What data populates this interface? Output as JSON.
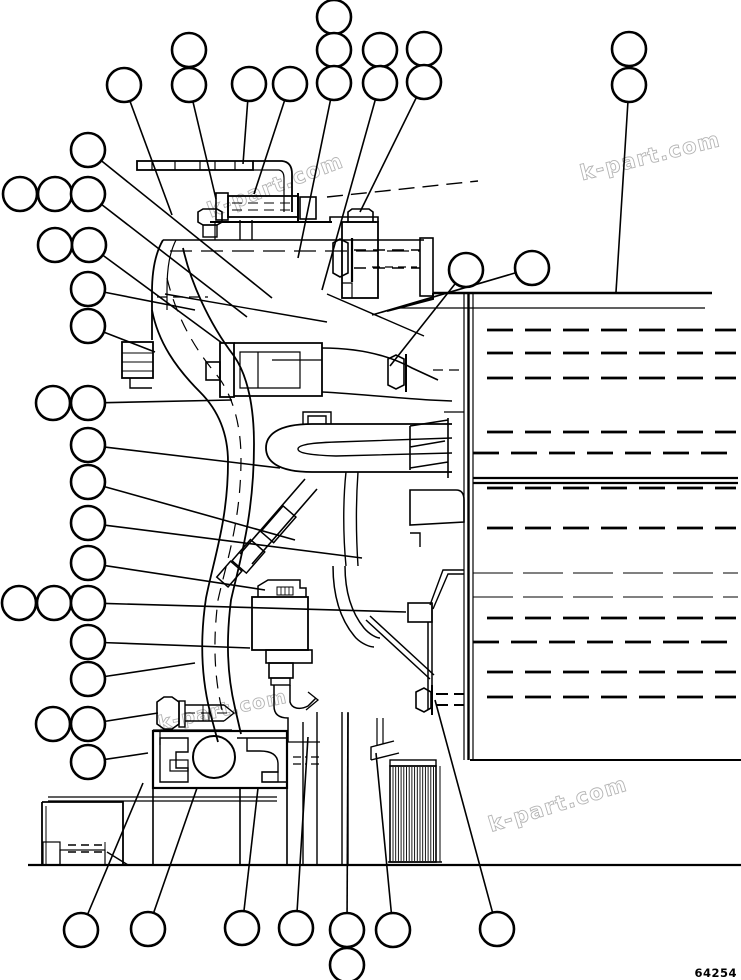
{
  "diagram": {
    "type": "exploded-parts-diagram",
    "part_number": "64254",
    "line_color": "#000000",
    "background_color": "#ffffff",
    "watermark": {
      "text": "k-part.com",
      "color": "#b4b4b4",
      "positions": [
        {
          "x": 278,
          "y": 192,
          "rot": -21,
          "size": 21
        },
        {
          "x": 652,
          "y": 163,
          "rot": -14,
          "size": 21
        },
        {
          "x": 224,
          "y": 716,
          "rot": -12,
          "size": 19
        },
        {
          "x": 560,
          "y": 811,
          "rot": -17,
          "size": 21
        }
      ]
    },
    "callout_radius": 17,
    "callout_stroke_width": 2.6,
    "leader_stroke_width": 1.6,
    "callouts": [
      {
        "cx": 124,
        "cy": 85,
        "leader": [
          172,
          215
        ]
      },
      {
        "cx": 189,
        "cy": 50,
        "leader": null
      },
      {
        "cx": 189,
        "cy": 85,
        "leader": [
          216,
          199
        ]
      },
      {
        "cx": 249,
        "cy": 84,
        "leader": [
          243,
          164
        ]
      },
      {
        "cx": 290,
        "cy": 84,
        "leader": [
          254,
          194
        ]
      },
      {
        "cx": 334,
        "cy": 17,
        "leader": null
      },
      {
        "cx": 334,
        "cy": 50,
        "leader": null
      },
      {
        "cx": 334,
        "cy": 83,
        "leader": [
          298,
          258
        ]
      },
      {
        "cx": 380,
        "cy": 50,
        "leader": null
      },
      {
        "cx": 380,
        "cy": 83,
        "leader": [
          322,
          290
        ]
      },
      {
        "cx": 424,
        "cy": 49,
        "leader": null
      },
      {
        "cx": 424,
        "cy": 82,
        "leader": [
          360,
          212
        ]
      },
      {
        "cx": 629,
        "cy": 49,
        "leader": null
      },
      {
        "cx": 629,
        "cy": 85,
        "leader": [
          616,
          292
        ]
      },
      {
        "cx": 88,
        "cy": 150,
        "leader": [
          272,
          298
        ]
      },
      {
        "cx": 20,
        "cy": 194,
        "leader": null
      },
      {
        "cx": 55,
        "cy": 194,
        "leader": null
      },
      {
        "cx": 88,
        "cy": 194,
        "leader": [
          247,
          317
        ]
      },
      {
        "cx": 55,
        "cy": 245,
        "leader": null
      },
      {
        "cx": 89,
        "cy": 245,
        "leader": [
          222,
          343
        ]
      },
      {
        "cx": 88,
        "cy": 289,
        "leader": [
          195,
          310
        ]
      },
      {
        "cx": 88,
        "cy": 326,
        "leader": [
          155,
          352
        ]
      },
      {
        "cx": 53,
        "cy": 403,
        "leader": null
      },
      {
        "cx": 88,
        "cy": 403,
        "leader": [
          232,
          400
        ]
      },
      {
        "cx": 88,
        "cy": 445,
        "leader": [
          280,
          468
        ]
      },
      {
        "cx": 88,
        "cy": 482,
        "leader": [
          295,
          540
        ]
      },
      {
        "cx": 88,
        "cy": 523,
        "leader": [
          362,
          558
        ]
      },
      {
        "cx": 88,
        "cy": 563,
        "leader": [
          265,
          590
        ]
      },
      {
        "cx": 19,
        "cy": 603,
        "leader": null
      },
      {
        "cx": 54,
        "cy": 603,
        "leader": null
      },
      {
        "cx": 88,
        "cy": 603,
        "leader": [
          406,
          612
        ]
      },
      {
        "cx": 88,
        "cy": 642,
        "leader": [
          250,
          648
        ]
      },
      {
        "cx": 88,
        "cy": 679,
        "leader": [
          195,
          663
        ]
      },
      {
        "cx": 53,
        "cy": 724,
        "leader": null
      },
      {
        "cx": 88,
        "cy": 724,
        "leader": [
          158,
          713
        ]
      },
      {
        "cx": 88,
        "cy": 762,
        "leader": [
          148,
          753
        ]
      },
      {
        "cx": 466,
        "cy": 270,
        "leader": [
          390,
          366
        ]
      },
      {
        "cx": 532,
        "cy": 268,
        "leader": [
          372,
          315
        ]
      },
      {
        "cx": 81,
        "cy": 930,
        "leader": [
          143,
          783
        ]
      },
      {
        "cx": 148,
        "cy": 929,
        "leader": [
          197,
          788
        ]
      },
      {
        "cx": 242,
        "cy": 928,
        "leader": [
          258,
          788
        ]
      },
      {
        "cx": 296,
        "cy": 928,
        "leader": [
          308,
          737
        ]
      },
      {
        "cx": 347,
        "cy": 930,
        "leader": [
          348,
          713
        ]
      },
      {
        "cx": 347,
        "cy": 965,
        "leader": null
      },
      {
        "cx": 393,
        "cy": 930,
        "leader": [
          376,
          753
        ]
      },
      {
        "cx": 497,
        "cy": 929,
        "leader": [
          435,
          700
        ]
      }
    ]
  }
}
